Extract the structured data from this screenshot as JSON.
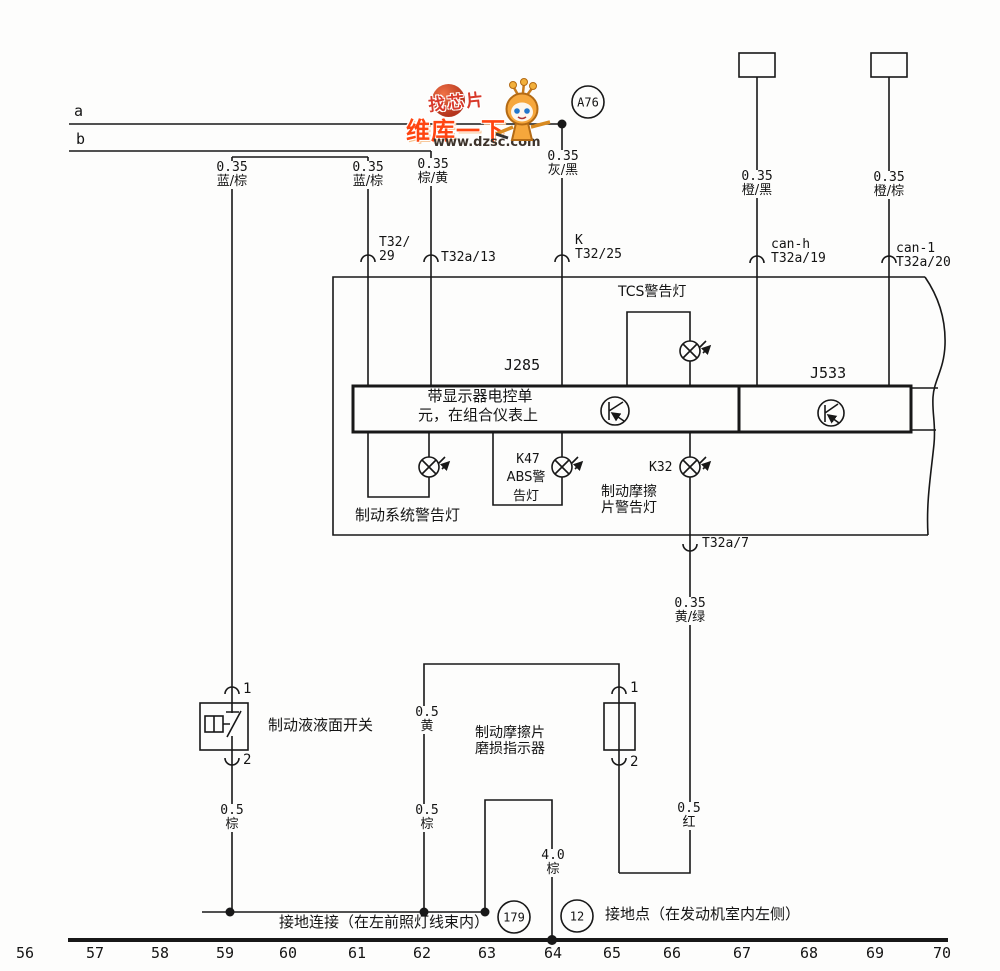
{
  "watermark": {
    "slogan": "找芯片",
    "brand": "维库一下",
    "url": "www.dzsc.com"
  },
  "top": {
    "line_a": "a",
    "line_b": "b",
    "node": "A76"
  },
  "wires": [
    {
      "size": "0.35",
      "color": "蓝/棕"
    },
    {
      "size": "0.35",
      "color": "蓝/棕"
    },
    {
      "size": "0.35",
      "color": "棕/黄"
    },
    {
      "size": "0.35",
      "color": "灰/黑"
    },
    {
      "size": "0.35",
      "color": "橙/黑"
    },
    {
      "size": "0.35",
      "color": "橙/棕"
    },
    {
      "size": "0.35",
      "color": "黄/绿"
    },
    {
      "size": "0.5",
      "color": "黄"
    },
    {
      "size": "0.5",
      "color": "棕"
    },
    {
      "size": "0.5",
      "color": "棕"
    },
    {
      "size": "4.0",
      "color": "棕"
    },
    {
      "size": "0.5",
      "color": "红"
    }
  ],
  "connectors": [
    {
      "l1": "T32/",
      "l2": "29"
    },
    {
      "l1": "T32a/13"
    },
    {
      "l1": "K",
      "l2": "T32/25"
    },
    {
      "l1": "can-h",
      "l2": "T32a/19"
    },
    {
      "l1": "can-1",
      "l2": "T32a/20"
    },
    {
      "l1": "T32a/7"
    }
  ],
  "ecu": {
    "designator": "J285",
    "gateway": "J533",
    "label_line1": "带显示器电控单",
    "label_line2": "元，在组合仪表上"
  },
  "lamps": {
    "tcs": "TCS警告灯",
    "brake_system": "制动系统警告灯",
    "abs_des": "K47",
    "abs_l1": "ABS警",
    "abs_l2": "告灯",
    "pad_des": "K32",
    "pad_l1": "制动摩擦",
    "pad_l2": "片警告灯"
  },
  "components": {
    "fluid_switch": "制动液液面开关",
    "pad_indicator_l1": "制动摩擦片",
    "pad_indicator_l2": "磨损指示器",
    "term1": "1",
    "term2": "2"
  },
  "ground": {
    "g179": "179",
    "g179_label": "接地连接（在左前照灯线束内）",
    "g12": "12",
    "g12_label": "接地点（在发动机室内左侧）"
  },
  "scale": [
    "56",
    "57",
    "58",
    "59",
    "60",
    "61",
    "62",
    "63",
    "64",
    "65",
    "66",
    "67",
    "68",
    "69",
    "70"
  ]
}
